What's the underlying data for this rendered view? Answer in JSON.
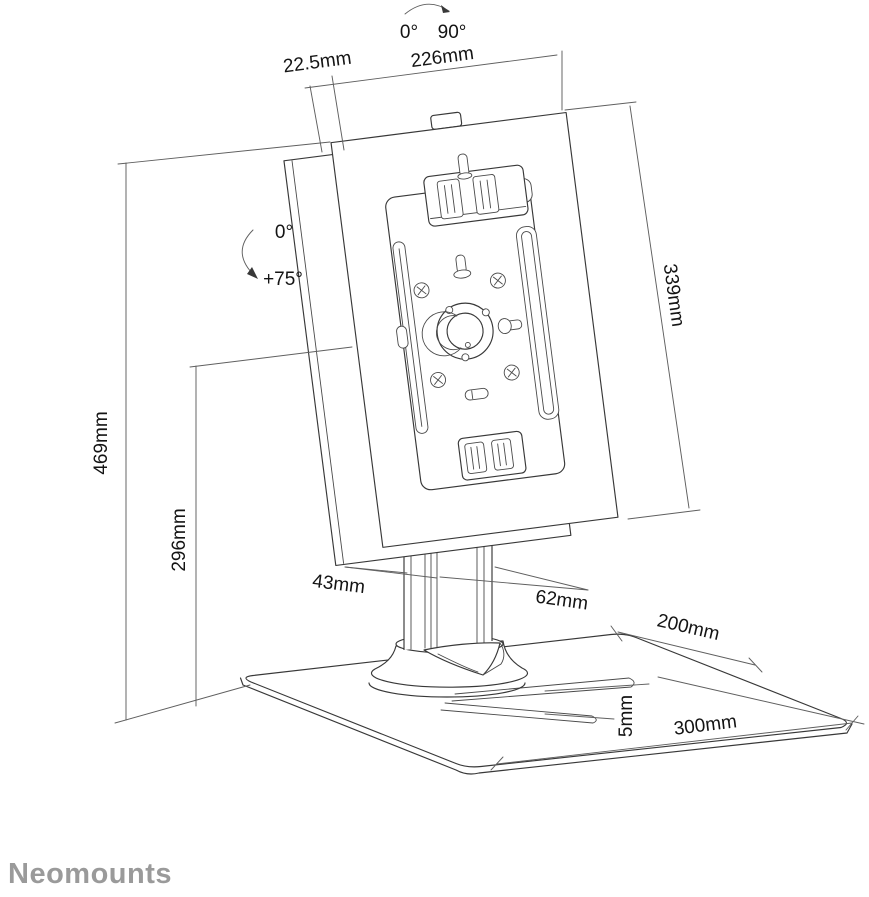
{
  "brand": {
    "name": "Neomounts",
    "color": "#9a9a9a"
  },
  "annotations": {
    "swivel_rotation": {
      "from_label": "0°",
      "to_label": "90°"
    },
    "tilt_rotation": {
      "from_label": "0°",
      "to_label": "+75°"
    }
  },
  "dimensions": {
    "enclosure_depth": "22.5mm",
    "enclosure_width": "226mm",
    "enclosure_height": "339mm",
    "total_height": "469mm",
    "hub_height": "296mm",
    "pole_depth": "43mm",
    "pole_width": "62mm",
    "base_depth": "200mm",
    "base_plate_thickness": "5mm",
    "base_width": "300mm"
  },
  "colors": {
    "drawing_line": "#383838",
    "dimension_line": "#5f5f5f",
    "label_text": "#141414",
    "background": "#ffffff",
    "logo": "#9a9a9a"
  }
}
